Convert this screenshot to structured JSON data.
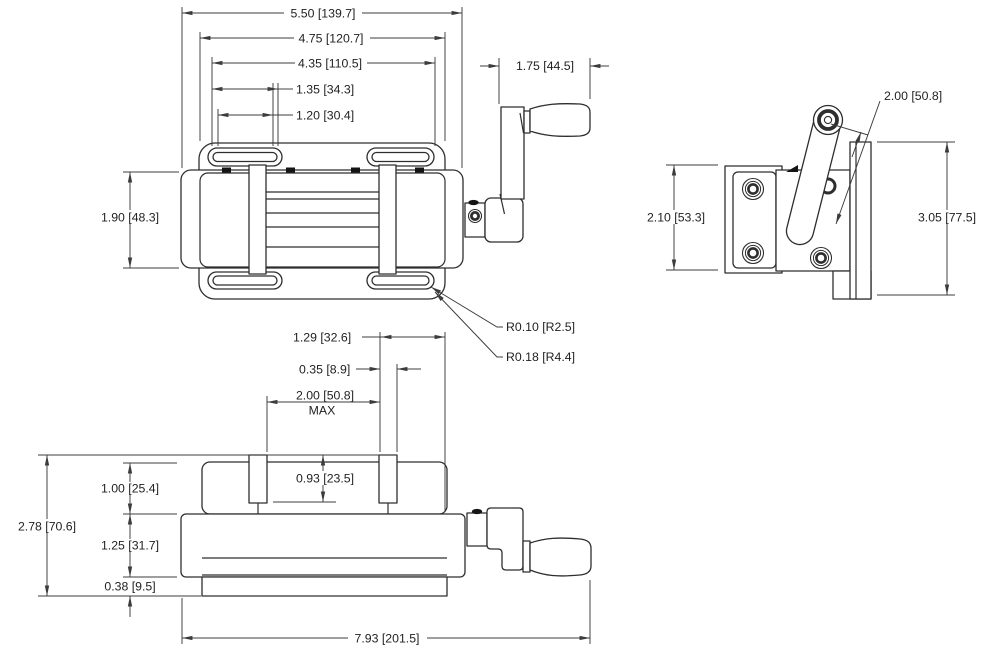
{
  "drawing": {
    "type": "engineering-dimension-drawing",
    "subject": "drill-press-vise-with-crank-handle",
    "background_color": "#ffffff",
    "line_color": "#2e2e2e",
    "dim_color": "#3c3c3c",
    "units_format": "inch [mm]"
  },
  "dims": {
    "top_overall_width": "5.50 [139.7]",
    "top_plate_width": "4.75 [120.7]",
    "top_slot_span": "4.35 [110.5]",
    "top_slot_length_outer": "1.35 [34.3]",
    "top_slot_length_inner": "1.20 [30.4]",
    "handle_offset": "1.75 [44.5]",
    "top_body_depth": "1.90 [48.3]",
    "crank_length": "2.00 [50.8]",
    "side_plate_height": "2.10 [53.3]",
    "side_overall_height": "3.05 [77.5]",
    "slot_radius_inner": "R0.10 [R2.5]",
    "slot_radius_outer": "R0.18 [R4.4]",
    "front_end_offset": "1.29 [32.6]",
    "front_jaw_thickness": "0.35 [8.9]",
    "jaw_opening": "2.00 [50.8]",
    "jaw_opening_suffix": "MAX",
    "jaw_height": "0.93 [23.5]",
    "front_top_height": "1.00 [25.4]",
    "front_overall_height": "2.78 [70.6]",
    "front_body_height": "1.25 [31.7]",
    "front_base_height": "0.38 [9.5]",
    "front_overall_length": "7.93 [201.5]"
  }
}
